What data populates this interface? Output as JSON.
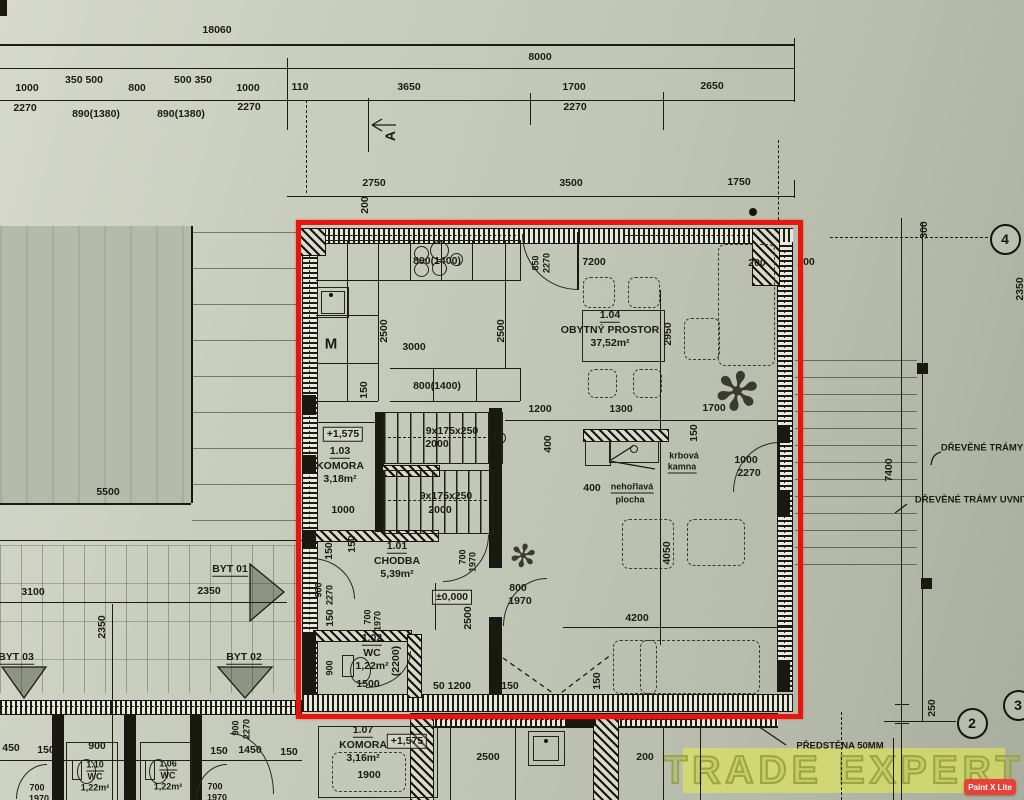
{
  "colors": {
    "ink": "#1c1c13",
    "red": "#e8150d",
    "paper": "#c2c6b6",
    "watermark_bg": "#e2e950",
    "watermark_stroke": "#9aa441",
    "badge_bg": "#e8413a",
    "badge_text": "#ffffff"
  },
  "watermark": {
    "text": "TRADE EXPERT",
    "badge": "Paint X Lite"
  },
  "highlight": {
    "x": 296,
    "y": 220,
    "w": 497,
    "h": 489
  },
  "plant_glyph": "✻",
  "rooms": [
    {
      "id": "1.01",
      "name": "CHODBA",
      "area": "5,39m²",
      "x": 397,
      "y": 547
    },
    {
      "id": "1.02",
      "name": "WC",
      "area": "1,22m²",
      "x": 372,
      "y": 639
    },
    {
      "id": "1.03",
      "name": "KOMORA",
      "area": "3,18m²",
      "x": 340,
      "y": 452
    },
    {
      "id": "1.04",
      "name": "OBYTNÝ PROSTOR",
      "area": "37,52m²",
      "x": 610,
      "y": 316
    },
    {
      "id": "1.06",
      "name": "WC",
      "area": "1,22m²",
      "x": 168,
      "y": 765,
      "small": 1
    },
    {
      "id": "1.07",
      "name": "KOMORA",
      "area": "3,16m²",
      "x": 363,
      "y": 731
    },
    {
      "id": "1.10",
      "name": "WC",
      "area": "1,22m²",
      "x": 95,
      "y": 766,
      "small": 1
    }
  ],
  "markers": [
    {
      "n": "4",
      "x": 1003,
      "y": 237
    },
    {
      "n": "2",
      "x": 970,
      "y": 721
    },
    {
      "n": "3",
      "x": 1016,
      "y": 703
    }
  ],
  "labels": [
    {
      "t": "18060",
      "x": 217,
      "y": 30
    },
    {
      "t": "8000",
      "x": 540,
      "y": 57
    },
    {
      "t": "1000",
      "x": 27,
      "y": 88
    },
    {
      "t": "350 500",
      "x": 84,
      "y": 80
    },
    {
      "t": "800",
      "x": 137,
      "y": 88
    },
    {
      "t": "500 350",
      "x": 193,
      "y": 80
    },
    {
      "t": "1000",
      "x": 248,
      "y": 88
    },
    {
      "t": "110",
      "x": 300,
      "y": 87
    },
    {
      "t": "3650",
      "x": 409,
      "y": 87
    },
    {
      "t": "1700",
      "x": 574,
      "y": 87
    },
    {
      "t": "2650",
      "x": 712,
      "y": 86
    },
    {
      "t": "2270",
      "x": 25,
      "y": 108
    },
    {
      "t": "890(1380)",
      "x": 96,
      "y": 114
    },
    {
      "t": "890(1380)",
      "x": 181,
      "y": 114
    },
    {
      "t": "2270",
      "x": 249,
      "y": 107
    },
    {
      "t": "2270",
      "x": 575,
      "y": 107
    },
    {
      "t": "A",
      "x": 390,
      "y": 136,
      "r": 1,
      "f": 14
    },
    {
      "t": "2750",
      "x": 374,
      "y": 183
    },
    {
      "t": "3500",
      "x": 571,
      "y": 183
    },
    {
      "t": "1750",
      "x": 739,
      "y": 182
    },
    {
      "t": "200",
      "x": 365,
      "y": 205,
      "r": 1
    },
    {
      "t": "800(1400)",
      "x": 437,
      "y": 261
    },
    {
      "t": "850",
      "x": 536,
      "y": 263,
      "r": 1,
      "f": 9
    },
    {
      "t": "2270",
      "x": 547,
      "y": 263,
      "r": 1,
      "f": 9
    },
    {
      "t": "7200",
      "x": 594,
      "y": 262
    },
    {
      "t": "200",
      "x": 757,
      "y": 263
    },
    {
      "t": "200",
      "x": 806,
      "y": 262
    },
    {
      "t": "300",
      "x": 924,
      "y": 230,
      "r": 1
    },
    {
      "t": "2350",
      "x": 1020,
      "y": 289,
      "r": 1
    },
    {
      "t": "2500",
      "x": 384,
      "y": 331,
      "r": 1
    },
    {
      "t": "3000",
      "x": 414,
      "y": 347
    },
    {
      "t": "M",
      "x": 331,
      "y": 344,
      "f": 15
    },
    {
      "t": "2500",
      "x": 501,
      "y": 331,
      "r": 1
    },
    {
      "t": "2950",
      "x": 668,
      "y": 334,
      "r": 1
    },
    {
      "t": "150",
      "x": 364,
      "y": 390,
      "r": 1
    },
    {
      "t": "800(1400)",
      "x": 437,
      "y": 386
    },
    {
      "t": "1200",
      "x": 540,
      "y": 409
    },
    {
      "t": "1300",
      "x": 621,
      "y": 409
    },
    {
      "t": "1700",
      "x": 714,
      "y": 408
    },
    {
      "t": "+1,575",
      "x": 343,
      "y": 434,
      "b": 1
    },
    {
      "t": "900",
      "x": 379,
      "y": 446,
      "r": 1,
      "f": 9
    },
    {
      "t": "9x175x250",
      "x": 452,
      "y": 431
    },
    {
      "t": "2000",
      "x": 437,
      "y": 444
    },
    {
      "t": "1000",
      "x": 343,
      "y": 510
    },
    {
      "t": "9x175x250",
      "x": 446,
      "y": 496
    },
    {
      "t": "2000",
      "x": 440,
      "y": 510
    },
    {
      "t": "400",
      "x": 548,
      "y": 444,
      "r": 1
    },
    {
      "t": "150",
      "x": 694,
      "y": 433,
      "r": 1
    },
    {
      "t": "400",
      "x": 592,
      "y": 488
    },
    {
      "t": "krbová",
      "x": 684,
      "y": 456,
      "f": 9
    },
    {
      "t": "kamna",
      "x": 682,
      "y": 468,
      "u": 1,
      "f": 9
    },
    {
      "t": "nehořlavá",
      "x": 632,
      "y": 488,
      "f": 9,
      "u": 1
    },
    {
      "t": "plocha",
      "x": 630,
      "y": 500,
      "f": 9
    },
    {
      "t": "1000",
      "x": 746,
      "y": 460
    },
    {
      "t": "2270",
      "x": 749,
      "y": 473
    },
    {
      "t": "4050",
      "x": 667,
      "y": 553,
      "r": 1
    },
    {
      "t": "150",
      "x": 329,
      "y": 551,
      "r": 1
    },
    {
      "t": "150",
      "x": 352,
      "y": 544,
      "r": 1
    },
    {
      "t": "700",
      "x": 463,
      "y": 557,
      "r": 1,
      "f": 9
    },
    {
      "t": "1970",
      "x": 473,
      "y": 562,
      "r": 1,
      "f": 9
    },
    {
      "t": "±0,000",
      "x": 452,
      "y": 597,
      "b": 1
    },
    {
      "t": "2500",
      "x": 468,
      "y": 618,
      "r": 1
    },
    {
      "t": "900",
      "x": 319,
      "y": 590,
      "r": 1,
      "f": 9
    },
    {
      "t": "2270",
      "x": 330,
      "y": 595,
      "r": 1,
      "f": 9
    },
    {
      "t": "150",
      "x": 330,
      "y": 618,
      "r": 1
    },
    {
      "t": "700",
      "x": 368,
      "y": 617,
      "r": 1,
      "f": 9
    },
    {
      "t": "1970",
      "x": 378,
      "y": 621,
      "r": 1,
      "f": 9
    },
    {
      "t": "800",
      "x": 518,
      "y": 588
    },
    {
      "t": "1970",
      "x": 520,
      "y": 601
    },
    {
      "t": "(2200)",
      "x": 396,
      "y": 661,
      "r": 1
    },
    {
      "t": "1500",
      "x": 368,
      "y": 684
    },
    {
      "t": "900",
      "x": 330,
      "y": 668,
      "r": 1,
      "f": 9
    },
    {
      "t": "50 1200",
      "x": 452,
      "y": 686
    },
    {
      "t": "150",
      "x": 510,
      "y": 686
    },
    {
      "t": "4200",
      "x": 637,
      "y": 618
    },
    {
      "t": "150",
      "x": 597,
      "y": 681,
      "r": 1
    },
    {
      "t": "2350",
      "x": 209,
      "y": 591
    },
    {
      "t": "3100",
      "x": 33,
      "y": 592
    },
    {
      "t": "2350",
      "x": 102,
      "y": 627,
      "r": 1
    },
    {
      "t": "5500",
      "x": 108,
      "y": 492
    },
    {
      "t": "BYT 01",
      "x": 230,
      "y": 570,
      "u": 1
    },
    {
      "t": "BYT 03",
      "x": 16,
      "y": 658,
      "u": 1
    },
    {
      "t": "BYT 02",
      "x": 244,
      "y": 658,
      "u": 1
    },
    {
      "t": "7400",
      "x": 889,
      "y": 470,
      "r": 1
    },
    {
      "t": "DŘEVĚNÉ TRÁMY",
      "x": 982,
      "y": 448,
      "f": 9.5
    },
    {
      "t": "DŘEVĚNÉ TRÁMY UVNITŘ",
      "x": 975,
      "y": 500,
      "f": 9.5
    },
    {
      "t": "250",
      "x": 932,
      "y": 708,
      "r": 1
    },
    {
      "t": "PŘEDSTĚNA 50MM",
      "x": 840,
      "y": 746,
      "f": 9.5
    },
    {
      "t": "+1,575",
      "x": 407,
      "y": 741,
      "b": 1
    },
    {
      "t": "1900",
      "x": 369,
      "y": 775
    },
    {
      "t": "2500",
      "x": 488,
      "y": 757
    },
    {
      "t": "200",
      "x": 645,
      "y": 757
    },
    {
      "t": "450",
      "x": 11,
      "y": 748
    },
    {
      "t": "150",
      "x": 46,
      "y": 750
    },
    {
      "t": "900",
      "x": 97,
      "y": 746
    },
    {
      "t": "150",
      "x": 219,
      "y": 751
    },
    {
      "t": "1450",
      "x": 250,
      "y": 750
    },
    {
      "t": "150",
      "x": 289,
      "y": 752
    },
    {
      "t": "700",
      "x": 37,
      "y": 788,
      "f": 9
    },
    {
      "t": "1970",
      "x": 39,
      "y": 799,
      "f": 9
    },
    {
      "t": "700",
      "x": 215,
      "y": 787,
      "f": 9
    },
    {
      "t": "1970",
      "x": 217,
      "y": 798,
      "f": 9
    },
    {
      "t": "900",
      "x": 236,
      "y": 728,
      "r": 1,
      "f": 9
    },
    {
      "t": "2270",
      "x": 247,
      "y": 729,
      "r": 1,
      "f": 9
    }
  ],
  "lines": [
    [
      0,
      44,
      795,
      2
    ],
    [
      0,
      68,
      795,
      1
    ],
    [
      0,
      100,
      795,
      1
    ],
    [
      287,
      196,
      508,
      1
    ],
    [
      0,
      503,
      191,
      2
    ],
    [
      0,
      540,
      302,
      1
    ],
    [
      0,
      602,
      287,
      1
    ],
    [
      0,
      760,
      302,
      1
    ],
    [
      563,
      627,
      230,
      1
    ],
    [
      505,
      420,
      285,
      1
    ],
    [
      660,
      290,
      1,
      355
    ],
    [
      901,
      218,
      1,
      582
    ],
    [
      922,
      222,
      1,
      500
    ],
    [
      112,
      604,
      1,
      196
    ],
    [
      287,
      58,
      1,
      72
    ],
    [
      306,
      100,
      1,
      93,
      1
    ],
    [
      530,
      93,
      1,
      32
    ],
    [
      663,
      92,
      1,
      38
    ],
    [
      794,
      38,
      1,
      64
    ],
    [
      794,
      180,
      1,
      18
    ],
    [
      778,
      140,
      1,
      80,
      1
    ],
    [
      368,
      98,
      1,
      54
    ],
    [
      841,
      712,
      1,
      88,
      1
    ],
    [
      893,
      738,
      1,
      62
    ],
    [
      830,
      237,
      158,
      1,
      1
    ],
    [
      884,
      721,
      72,
      1
    ],
    [
      895,
      704,
      14,
      1
    ],
    [
      895,
      723,
      14,
      1
    ],
    [
      316,
      240,
      204,
      1
    ],
    [
      316,
      280,
      204,
      1
    ],
    [
      347,
      240,
      1,
      161
    ],
    [
      378,
      240,
      1,
      161
    ],
    [
      410,
      240,
      1,
      41
    ],
    [
      441,
      240,
      1,
      41
    ],
    [
      472,
      240,
      1,
      41
    ],
    [
      505,
      240,
      1,
      129
    ],
    [
      520,
      240,
      1,
      41
    ],
    [
      316,
      315,
      62,
      1
    ],
    [
      316,
      363,
      62,
      1
    ],
    [
      316,
      401,
      62,
      1
    ],
    [
      390,
      368,
      130,
      1
    ],
    [
      390,
      401,
      130,
      1
    ],
    [
      433,
      368,
      1,
      33
    ],
    [
      476,
      368,
      1,
      33
    ],
    [
      520,
      368,
      1,
      33
    ],
    [
      316,
      422,
      67,
      1
    ],
    [
      383,
      412,
      1,
      119
    ],
    [
      383,
      437,
      118,
      1,
      1
    ],
    [
      383,
      500,
      114,
      1,
      1
    ],
    [
      435,
      583,
      1,
      47
    ],
    [
      436,
      726,
      342,
      1
    ],
    [
      450,
      727,
      1,
      73
    ],
    [
      515,
      727,
      1,
      73
    ],
    [
      663,
      727,
      1,
      73
    ],
    [
      700,
      726,
      1,
      74
    ],
    [
      320,
      235,
      196,
      1,
      1
    ],
    [
      625,
      235,
      125,
      1,
      1
    ],
    [
      435,
      719,
      260,
      1,
      1
    ],
    [
      0,
      706,
      300,
      1,
      1
    ],
    [
      309,
      250,
      1,
      440,
      1
    ],
    [
      784,
      250,
      1,
      438,
      1
    ]
  ],
  "walls": [
    [
      298,
      228,
      495,
      14,
      "h"
    ],
    [
      302,
      242,
      14,
      452,
      "v"
    ],
    [
      777,
      242,
      14,
      450,
      "v"
    ],
    [
      302,
      694,
      491,
      16,
      "h"
    ],
    [
      0,
      700,
      302,
      13,
      "h"
    ],
    [
      430,
      713,
      270,
      13,
      "h"
    ],
    [
      700,
      713,
      78,
      13,
      "h"
    ]
  ],
  "hatches": [
    [
      300,
      228,
      24,
      26
    ],
    [
      752,
      228,
      26,
      56
    ],
    [
      375,
      465,
      63,
      10
    ],
    [
      312,
      530,
      125,
      10
    ],
    [
      313,
      630,
      97,
      10
    ],
    [
      407,
      634,
      13,
      62
    ],
    [
      583,
      429,
      84,
      11
    ],
    [
      593,
      715,
      24,
      85
    ],
    [
      410,
      713,
      22,
      87
    ]
  ],
  "solids": [
    [
      303,
      395,
      13,
      20
    ],
    [
      303,
      455,
      13,
      18
    ],
    [
      303,
      530,
      13,
      18
    ],
    [
      303,
      632,
      13,
      62
    ],
    [
      777,
      425,
      13,
      18
    ],
    [
      777,
      490,
      13,
      25
    ],
    [
      777,
      660,
      13,
      32
    ],
    [
      489,
      408,
      13,
      160
    ],
    [
      489,
      617,
      13,
      77
    ],
    [
      375,
      412,
      8,
      120
    ],
    [
      917,
      363,
      11,
      11
    ],
    [
      921,
      578,
      11,
      11
    ],
    [
      52,
      714,
      12,
      86
    ],
    [
      124,
      714,
      12,
      86
    ],
    [
      190,
      714,
      12,
      86
    ],
    [
      566,
      713,
      30,
      13
    ],
    [
      577,
      232,
      2,
      58
    ],
    [
      777,
      440,
      3,
      50
    ],
    [
      0,
      0,
      7,
      16
    ]
  ],
  "treads": [
    [
      383,
      412,
      118,
      50,
      13
    ],
    [
      383,
      470,
      114,
      62,
      12
    ]
  ],
  "decks": [
    [
      192,
      232,
      108,
      300,
      "h",
      36,
      0.5
    ],
    [
      0,
      545,
      300,
      148,
      "v",
      21,
      0.3
    ],
    [
      0,
      545,
      300,
      148,
      "h",
      38,
      0.25
    ],
    [
      795,
      360,
      122,
      212,
      "h",
      17,
      0.55
    ]
  ],
  "furniture": [
    [
      583,
      277,
      30,
      29
    ],
    [
      628,
      277,
      30,
      29
    ],
    [
      588,
      369,
      27,
      27
    ],
    [
      633,
      369,
      27,
      27
    ],
    [
      718,
      244,
      55,
      120
    ],
    [
      684,
      318,
      34,
      40
    ],
    [
      622,
      519,
      50,
      48
    ],
    [
      687,
      519,
      56,
      45
    ],
    [
      613,
      640,
      42,
      52
    ],
    [
      640,
      640,
      118,
      52
    ],
    [
      332,
      752,
      72,
      38
    ]
  ],
  "thinrects": [
    [
      582,
      310,
      81,
      50
    ],
    [
      317,
      287,
      30,
      29
    ],
    [
      321,
      291,
      22,
      21
    ],
    [
      528,
      731,
      35,
      33
    ],
    [
      533,
      736,
      24,
      23
    ],
    [
      585,
      441,
      24,
      23
    ],
    [
      609,
      441,
      48,
      20
    ],
    [
      318,
      726,
      118,
      70
    ],
    [
      66,
      742,
      50,
      58
    ],
    [
      140,
      742,
      50,
      58
    ],
    [
      342,
      655,
      10,
      20
    ],
    [
      72,
      760,
      8,
      18
    ],
    [
      145,
      760,
      8,
      18
    ]
  ],
  "ellipses": [
    [
      350,
      657,
      19,
      25
    ],
    [
      77,
      759,
      17,
      23
    ],
    [
      149,
      759,
      17,
      23
    ]
  ],
  "circles": [
    [
      420,
      252,
      13
    ],
    [
      438,
      249,
      17
    ],
    [
      420,
      268,
      13
    ],
    [
      438,
      267,
      13
    ],
    [
      455,
      258,
      11
    ],
    [
      499,
      437,
      10
    ],
    [
      633,
      448,
      6
    ]
  ],
  "dots": [
    [
      753,
      212,
      8
    ],
    [
      331,
      295,
      4
    ],
    [
      546,
      741,
      4
    ]
  ],
  "arcs": [
    [
      522,
      234,
      55,
      55,
      "bl"
    ],
    [
      733,
      442,
      45,
      49,
      "tl"
    ],
    [
      443,
      535,
      45,
      46,
      "br"
    ],
    [
      311,
      558,
      43,
      40,
      "tr"
    ],
    [
      366,
      651,
      44,
      36,
      "br"
    ],
    [
      503,
      578,
      43,
      47,
      "tl"
    ],
    [
      16,
      764,
      30,
      34,
      "tl"
    ],
    [
      196,
      764,
      30,
      34,
      "tl"
    ],
    [
      230,
      733,
      43,
      60,
      "tr"
    ]
  ],
  "plants": [
    [
      737,
      392,
      54
    ],
    [
      523,
      556,
      32
    ]
  ],
  "svgpaths": [
    {
      "d": "M396,125 L372,125 M372,125 l10,-6 M372,125 l10,6"
    },
    {
      "d": "M609,461 L655,469 M633,446 L611,460"
    },
    {
      "d": "M752,722 L786,745"
    },
    {
      "d": "M941,452 c-7,2 -9,6 -10,13"
    },
    {
      "d": "M907,504 l-12,9"
    },
    {
      "d": "M503,658 L557,696 L612,654",
      "dash": 1
    },
    {
      "d": "M250,564 L250,621 L284,592 Z",
      "fill": 1
    },
    {
      "d": "M218,667 L272,667 L245,698 Z",
      "fill": 1
    },
    {
      "d": "M2,667 L46,667 L24,698 Z",
      "fill": 1
    }
  ]
}
